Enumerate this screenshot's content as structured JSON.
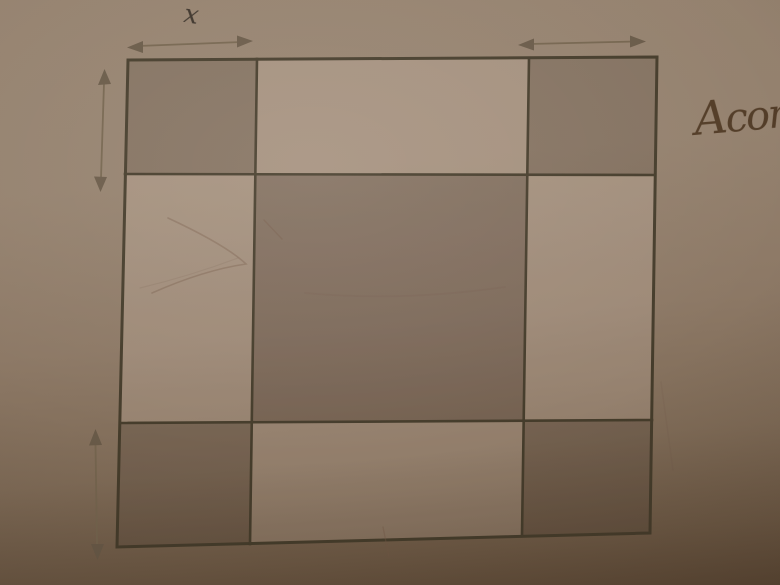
{
  "figure": {
    "type": "geometry-diagram",
    "labels": {
      "x": "x"
    },
    "handwriting": "Acor",
    "grid": {
      "rows": 3,
      "cols": 3,
      "shaded_cells": [
        "top-left",
        "top-right",
        "center",
        "bottom-left",
        "bottom-right"
      ],
      "light_cells": [
        "top-middle",
        "middle-left",
        "middle-right",
        "bottom-middle"
      ]
    },
    "arrows": [
      {
        "id": "top-left-width",
        "orientation": "horizontal",
        "label": "x"
      },
      {
        "id": "top-right-width",
        "orientation": "horizontal",
        "label": ""
      },
      {
        "id": "left-height-upper",
        "orientation": "vertical",
        "label": ""
      },
      {
        "id": "left-height-lower",
        "orientation": "vertical",
        "label": ""
      }
    ],
    "colors": {
      "paper_top": "#95826f",
      "paper_bottom": "#5c4835",
      "cell_light_overlay": "rgba(255,238,224,0.15)",
      "cell_shaded_overlay": "rgba(56,44,36,0.17)",
      "cell_center_overlay": "rgba(58,44,40,0.19)",
      "grid_line": "#453c2b",
      "arrow_line": "#75654f",
      "arrow_head": "#695a48",
      "label": "#3c332a",
      "handwriting": "#523c27",
      "pencil": "rgba(115,90,72,0.38)",
      "pencil_faint": "rgba(115,90,72,0.16)"
    }
  }
}
